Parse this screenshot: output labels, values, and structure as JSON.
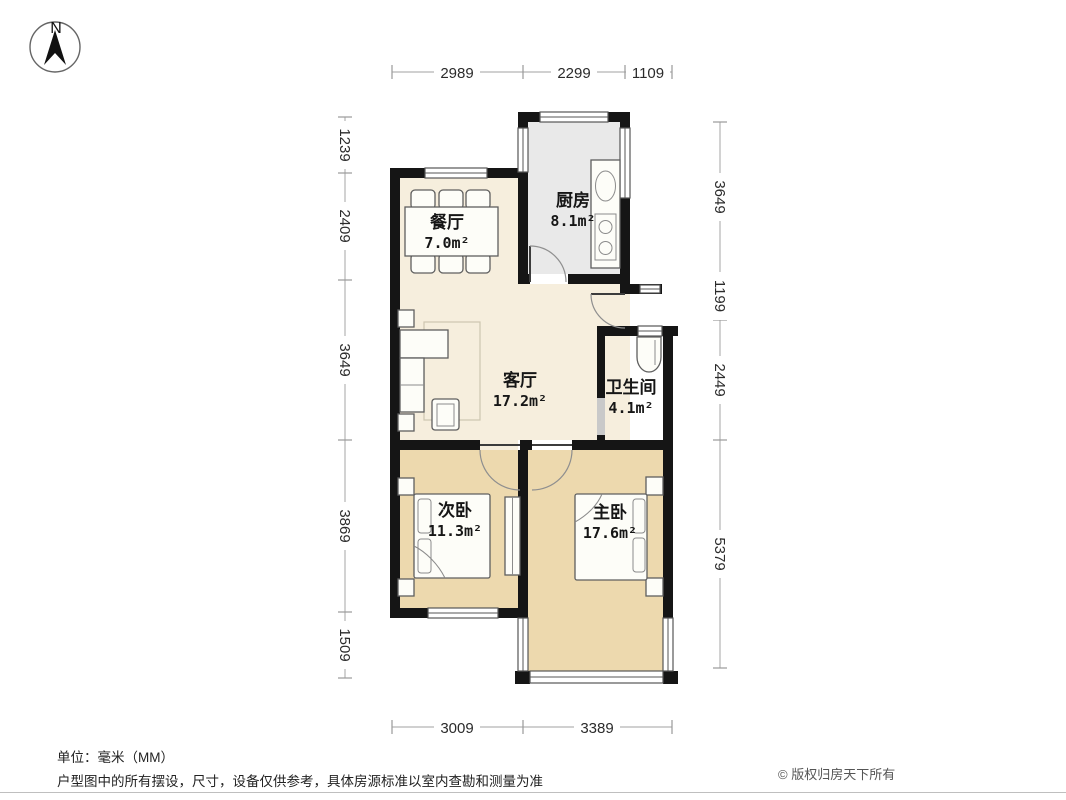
{
  "compass": {
    "north_label": "N"
  },
  "rooms": {
    "dining": {
      "name": "餐厅",
      "area": "7.0m²"
    },
    "kitchen": {
      "name": "厨房",
      "area": "8.1m²"
    },
    "living": {
      "name": "客厅",
      "area": "17.2m²"
    },
    "bathroom": {
      "name": "卫生间",
      "area": "4.1m²"
    },
    "bedroom2": {
      "name": "次卧",
      "area": "11.3m²"
    },
    "bedroom1": {
      "name": "主卧",
      "area": "17.6m²"
    }
  },
  "dimensions_mm": {
    "top": [
      "2989",
      "2299",
      "1109"
    ],
    "left": [
      "1239",
      "2409",
      "3649",
      "3869",
      "1509"
    ],
    "right": [
      "3649",
      "1199",
      "2449",
      "5379"
    ],
    "bottom": [
      "3009",
      "3389"
    ]
  },
  "footer": {
    "unit_note": "单位：毫米（MM）",
    "disclaimer": "户型图中的所有摆设，尺寸，设备仅供参考，具体房源标准以室内查勘和测量为准",
    "copyright": "© 版权归房天下所有"
  },
  "colors": {
    "wall": "#151515",
    "floor_public": "#f6eedd",
    "floor_bedroom": "#edd9ae",
    "floor_wet": "#e9e9e9",
    "dimension_line": "#b4b4b4"
  }
}
